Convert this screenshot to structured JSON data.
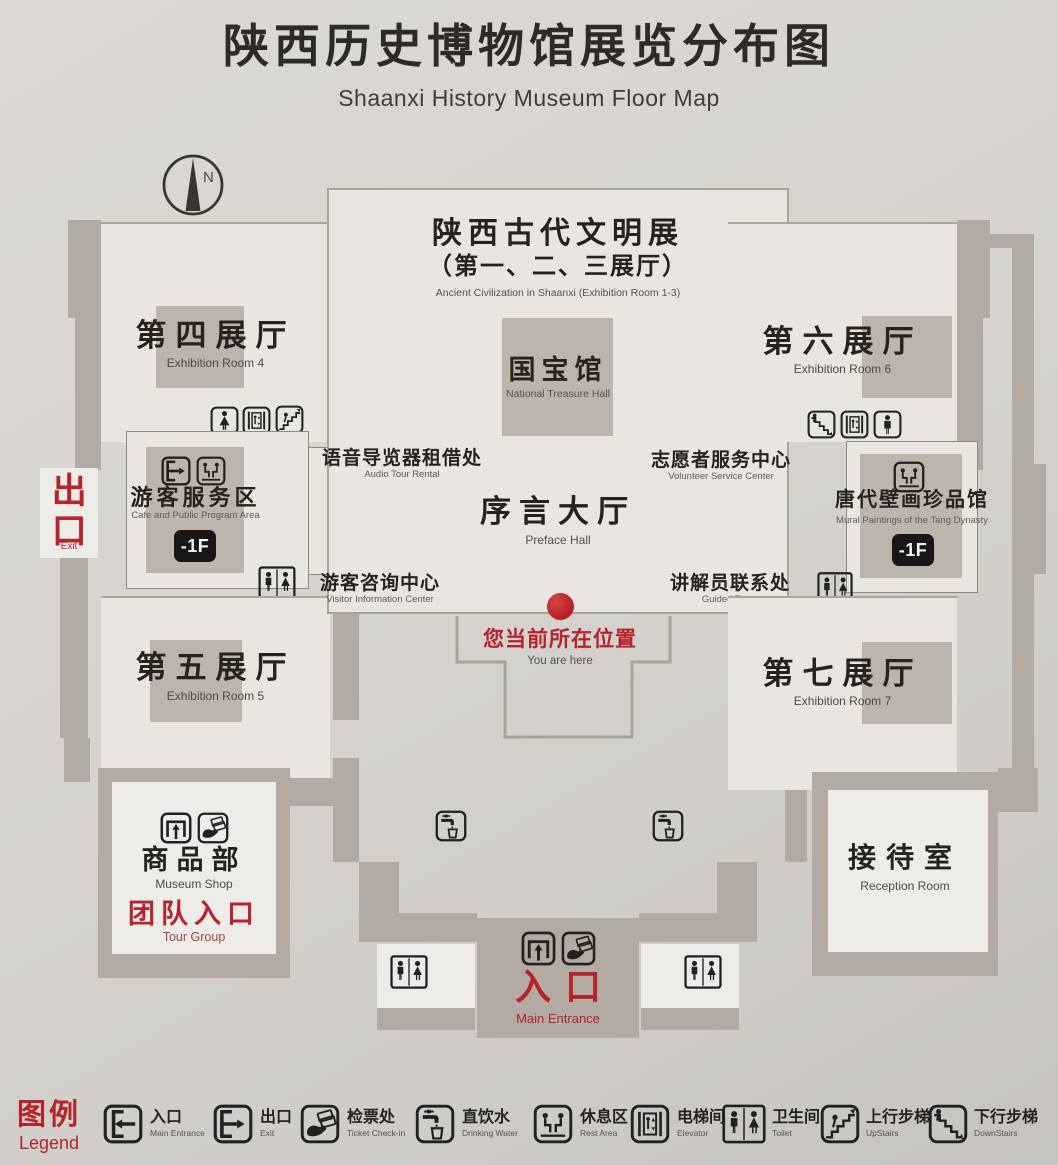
{
  "title": {
    "zh": "陕西历史博物馆展览分布图",
    "en": "Shaanxi History Museum Floor Map"
  },
  "compass": {
    "label": "N"
  },
  "colors": {
    "background": "#d7d4d0",
    "wall": "#b3aaa2",
    "room": "#e9e6e2",
    "accent_red": "#b5242a",
    "badge_black": "#191716"
  },
  "central": {
    "ancient_exhibit": {
      "zh": "陕西古代文明展",
      "zh_rooms": "（第一、二、三展厅）",
      "en": "Ancient Civilization in Shaanxi (Exhibition Room 1-3)"
    },
    "national_treasure": {
      "zh": "国宝馆",
      "en": "National Treasure Hall"
    },
    "audio_tour": {
      "zh": "语音导览器租借处",
      "en": "Audio Tour Rental"
    },
    "volunteer": {
      "zh": "志愿者服务中心",
      "en": "Volunteer Service Center"
    },
    "preface_hall": {
      "zh": "序言大厅",
      "en": "Preface Hall"
    },
    "visitor_info": {
      "zh": "游客咨询中心",
      "en": "Visitor Information Center"
    },
    "guided_tours": {
      "zh": "讲解员联系处",
      "en": "Guided Tours"
    },
    "you_are_here": {
      "zh": "您当前所在位置",
      "en": "You are here"
    }
  },
  "left_wing": {
    "exit": {
      "zh": "出口",
      "en": "Exit"
    },
    "room4": {
      "zh": "第四展厅",
      "en": "Exhibition Room 4"
    },
    "service_area": {
      "zh": "游客服务区",
      "en": "Cafe and Public Program Area",
      "floor": "-1F"
    },
    "room5": {
      "zh": "第五展厅",
      "en": "Exhibition Room 5"
    },
    "shop": {
      "zh": "商品部",
      "en": "Museum Shop"
    },
    "tour_group": {
      "zh": "团队入口",
      "en": "Tour Group"
    }
  },
  "right_wing": {
    "room6": {
      "zh": "第六展厅",
      "en": "Exhibition Room 6"
    },
    "murals": {
      "zh": "唐代壁画珍品馆",
      "en": "Mural Paintings of the Tang Dynasty",
      "floor": "-1F"
    },
    "room7": {
      "zh": "第七展厅",
      "en": "Exhibition Room 7"
    },
    "reception": {
      "zh": "接待室",
      "en": "Reception Room"
    }
  },
  "entrance": {
    "zh": "入口",
    "en": "Main Entrance"
  },
  "legend": {
    "title": {
      "zh": "图例",
      "en": "Legend"
    },
    "items": [
      {
        "icon": "door-in-icon",
        "zh": "入口",
        "en": "Main Entrance"
      },
      {
        "icon": "door-out-icon",
        "zh": "出口",
        "en": "Exit"
      },
      {
        "icon": "ticket-icon",
        "zh": "检票处",
        "en": "Ticket Check-in"
      },
      {
        "icon": "water-icon",
        "zh": "直饮水",
        "en": "Drinking Water"
      },
      {
        "icon": "rest-icon",
        "zh": "休息区",
        "en": "Rest Area"
      },
      {
        "icon": "elevator-icon",
        "zh": "电梯间",
        "en": "Elevator"
      },
      {
        "icon": "toilet-icon",
        "zh": "卫生间",
        "en": "Toilet"
      },
      {
        "icon": "stairs-up-icon",
        "zh": "上行步梯",
        "en": "UpStairs"
      },
      {
        "icon": "stairs-down-icon",
        "zh": "下行步梯",
        "en": "DownStairs"
      }
    ]
  }
}
